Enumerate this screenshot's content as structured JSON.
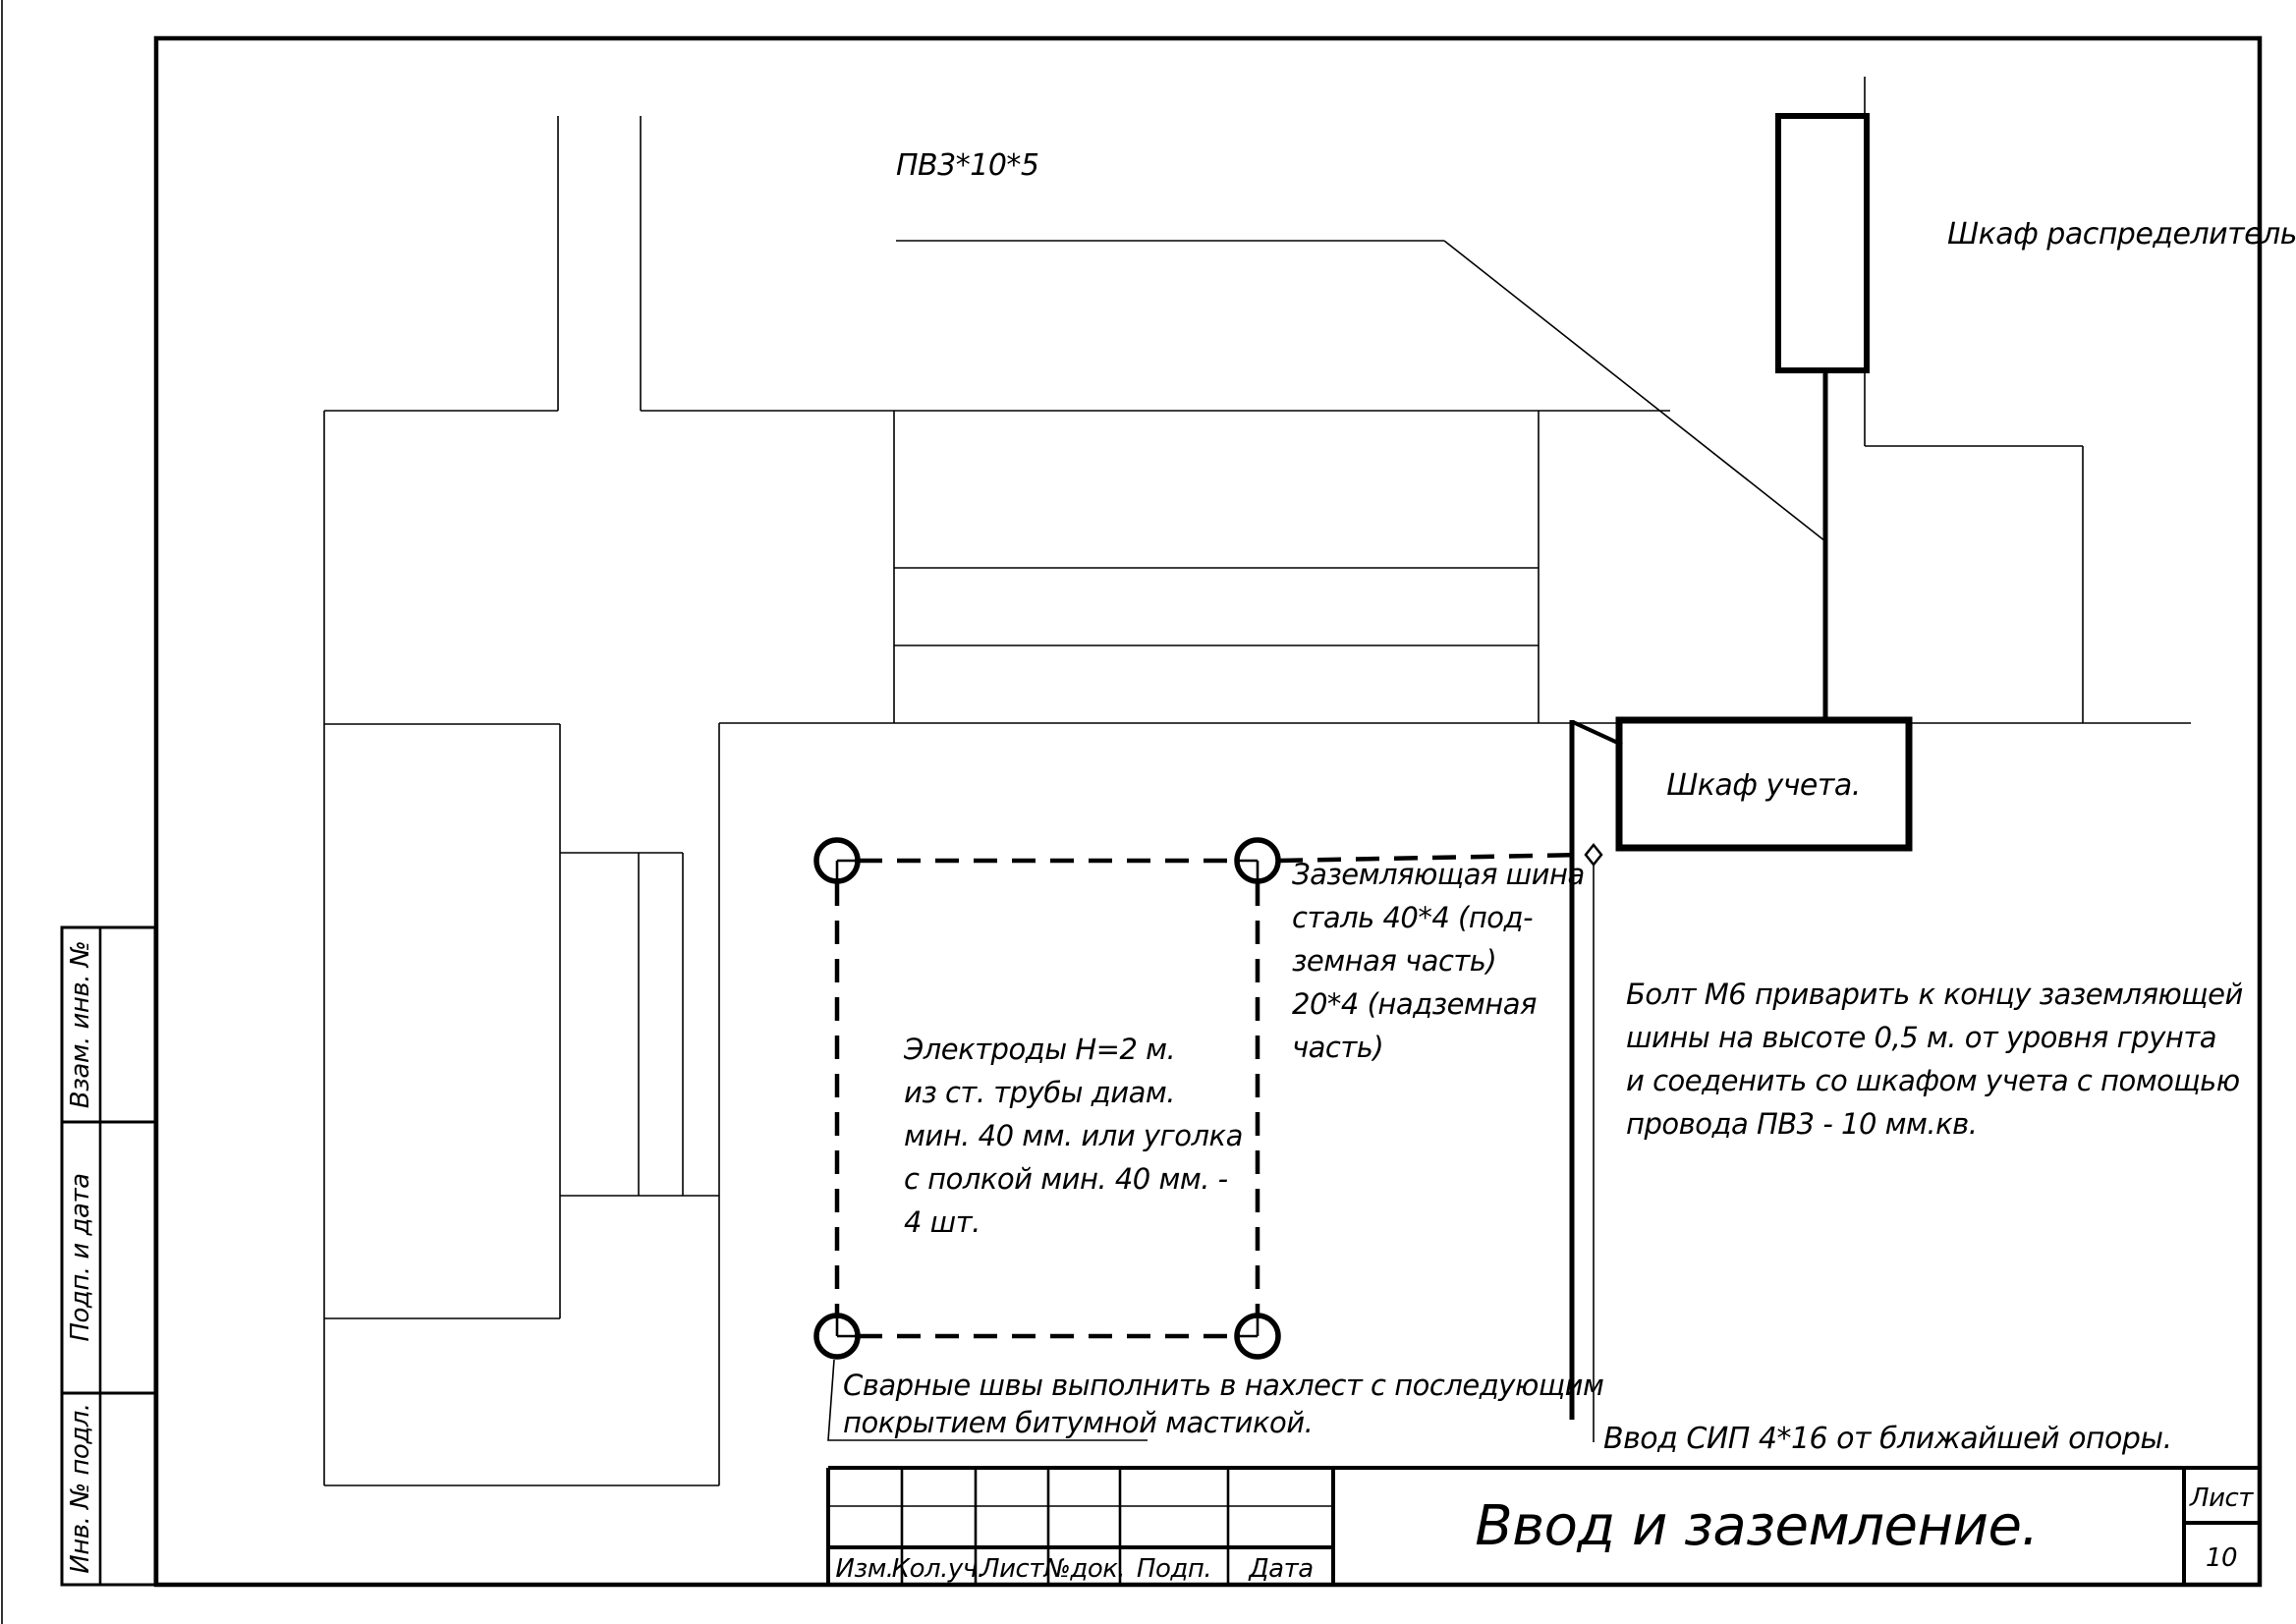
{
  "drawing": {
    "cable_label": "ПВ3*10*5",
    "distribution_cabinet_label": "Шкаф распределительный",
    "meter_cabinet_label": "Шкаф учета.",
    "sip_note": "Ввод СИП 4*16 от ближайшей опоры.",
    "notes": {
      "ground_bus": {
        "lines": [
          "Заземляющая шина",
          "сталь 40*4 (под-",
          "земная часть)",
          "20*4 (надземная",
          "часть)"
        ]
      },
      "electrodes": {
        "lines": [
          "Электроды Н=2 м.",
          "из ст. трубы диам.",
          "мин. 40 мм. или уголка",
          "с полкой мин. 40 мм. -",
          "4 шт."
        ]
      },
      "bolt": {
        "lines": [
          "Болт М6 приварить к концу заземляющей",
          "шины на высоте 0,5 м. от уровня грунта",
          "и соеденить со шкафом учета с помощью",
          "провода ПВ3 - 10 мм.кв."
        ]
      },
      "weld": {
        "lines": [
          "Сварные швы выполнить в нахлест с последующим",
          "покрытием битумной мастикой."
        ]
      }
    }
  },
  "title_block": {
    "title": "Ввод и заземление.",
    "sheet_label": "Лист",
    "sheet_number": "10",
    "columns": [
      "Изм.",
      "Кол.уч.",
      "Лист",
      "№док.",
      "Подп.",
      "Дата"
    ]
  },
  "side_labels": [
    "Взам. инв. №",
    "Подп. и дата",
    "Инв. № подл."
  ],
  "colors": {
    "ink": "#000000",
    "paper": "#ffffff"
  }
}
